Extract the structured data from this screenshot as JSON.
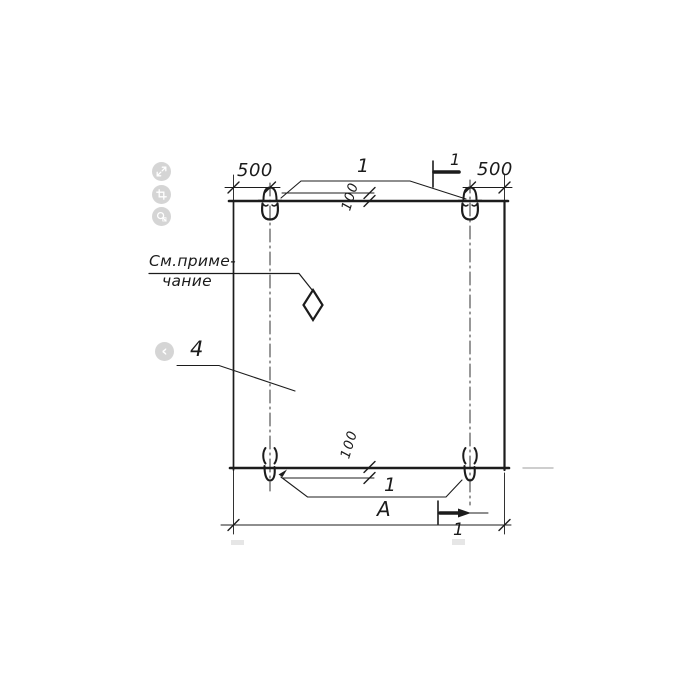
{
  "viewer": {
    "toolbar": [
      {
        "name": "expand-icon"
      },
      {
        "name": "crop-icon"
      },
      {
        "name": "search-fragment-icon"
      }
    ],
    "prev_glyph": "‹"
  },
  "drawing": {
    "ink_color": "#1c1c1c",
    "dimensions": {
      "top_left": "500",
      "top_right": "500",
      "top_offset": "100",
      "bottom_offset": "100",
      "overall_width": "А"
    },
    "callouts": {
      "loops_top": "1",
      "loops_bottom": "1",
      "panel": "4"
    },
    "section_marks": {
      "top": "1",
      "bottom": "1"
    },
    "note": {
      "line1": "См.приме-",
      "line2": "чание"
    }
  }
}
